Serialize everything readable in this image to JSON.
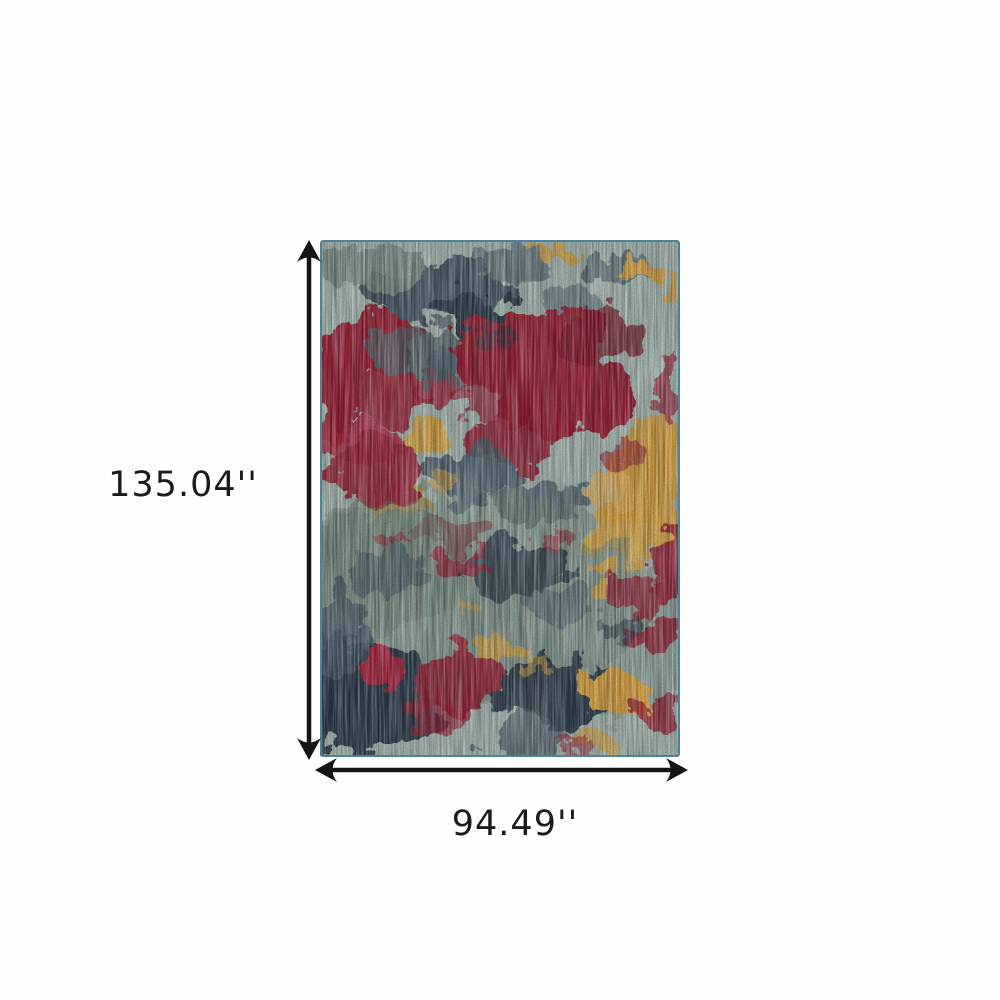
{
  "figure": {
    "background_color": "#ffffff",
    "arrow_color": "#141414",
    "label_color": "#1b1b1b"
  },
  "dimensions": {
    "height_label": "135.04''",
    "width_label": "94.49''"
  },
  "rug": {
    "description": "Abstract multicolor area rug in blue grey, red and gold",
    "palette": {
      "base": "#a9bbb5",
      "muted_teal": "#7e948c",
      "green_gray": "#6f8578",
      "slate_dark": "#2e3e4d",
      "slate": "#495d6b",
      "slate_mid": "#54646d",
      "red": "#9b2136",
      "red_dark": "#7a1728",
      "red_bright": "#ad2740",
      "gold": "#d9a544",
      "gold_light": "#e3b45c",
      "edge_teal": "#4e8399"
    }
  }
}
